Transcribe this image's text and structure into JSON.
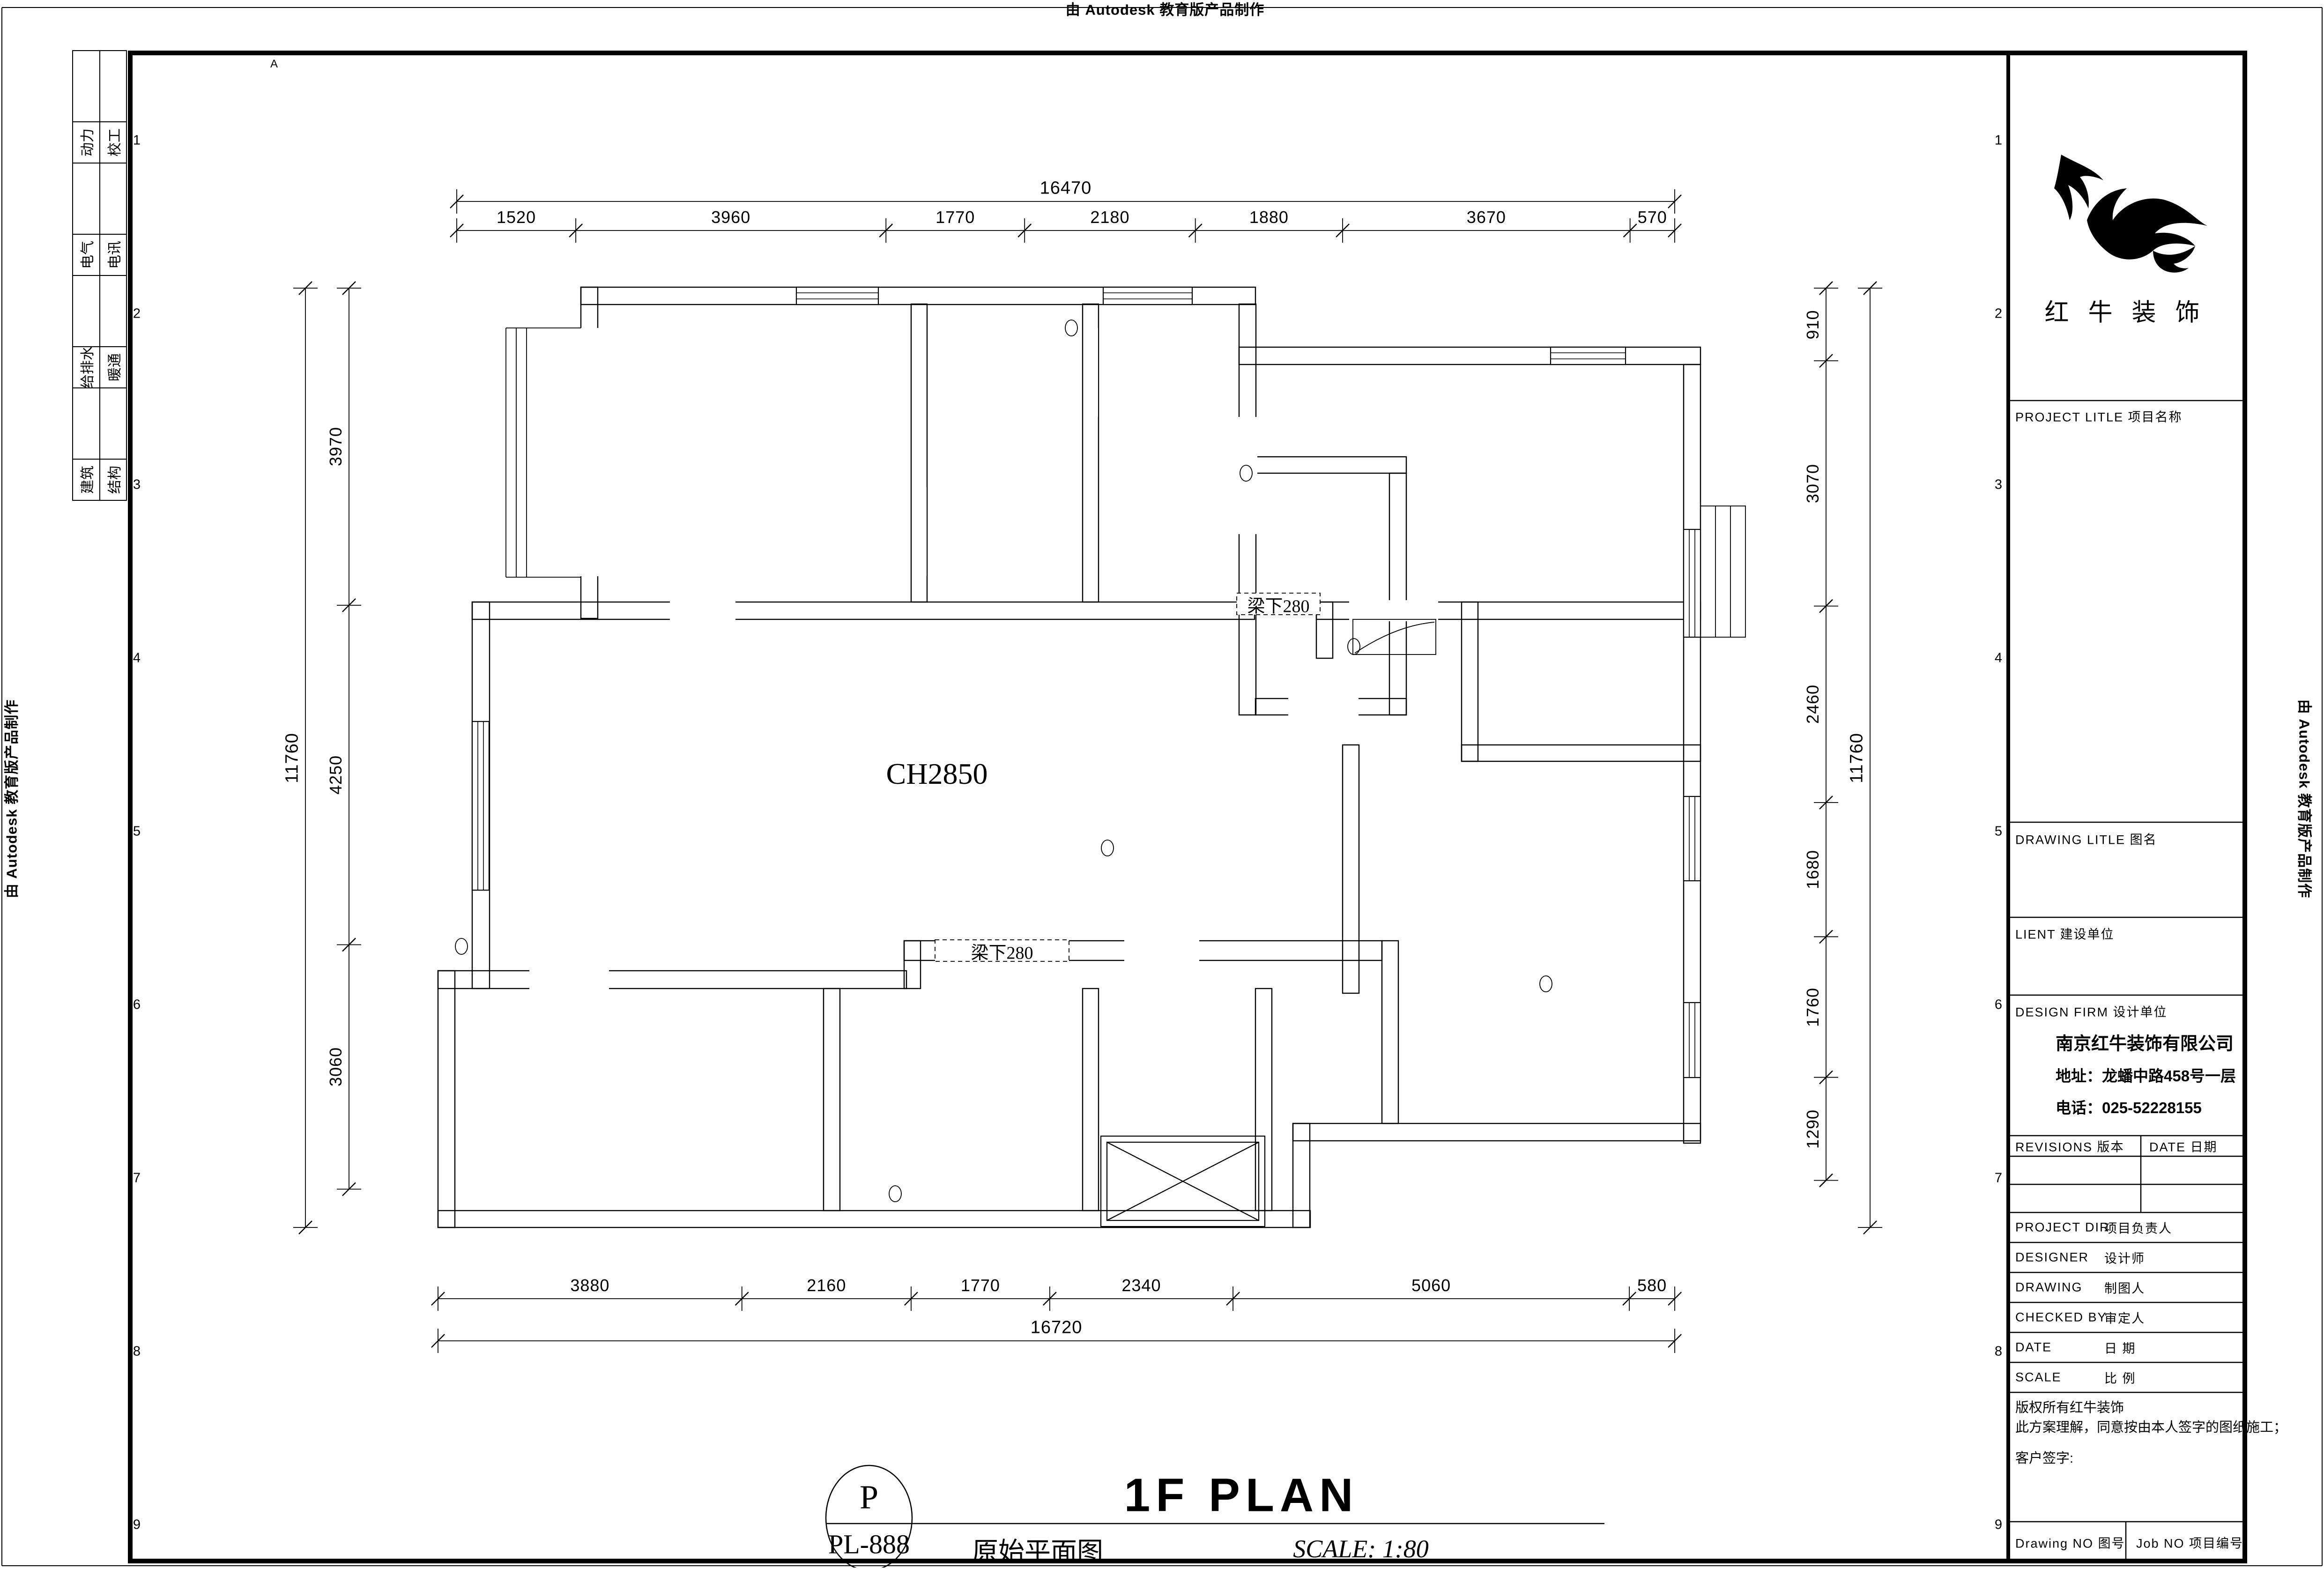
{
  "sheet": {
    "watermark_top": "由 Autodesk 教育版产品制作",
    "watermark_left": "由 Autodesk 教育版产品制作",
    "watermark_right": "由 Autodesk 教育版产品制作"
  },
  "frame_grid": {
    "left_numbers": [
      "1",
      "2",
      "3",
      "4",
      "5",
      "6",
      "7",
      "8",
      "9"
    ],
    "right_numbers": [
      "1",
      "2",
      "3",
      "4",
      "5",
      "6",
      "7",
      "8",
      "9"
    ],
    "top_letters": [
      "A"
    ]
  },
  "discipline_table": {
    "rows": [
      {
        "col1": "动力",
        "col2": "校工"
      },
      {
        "col1": "电气",
        "col2": "电讯"
      },
      {
        "col1": "给排水",
        "col2": "暖通"
      },
      {
        "col1": "建筑",
        "col2": "结构"
      }
    ]
  },
  "plan": {
    "room_height_label": "CH2850",
    "beam_labels": [
      "梁下280",
      "梁下280"
    ],
    "dimensions": {
      "top": {
        "total": "16470",
        "segments": [
          "1520",
          "3960",
          "1770",
          "2180",
          "1880",
          "3670",
          "570"
        ]
      },
      "bottom": {
        "total": "16720",
        "segments": [
          "3880",
          "2160",
          "1770",
          "2340",
          "5060",
          "580"
        ]
      },
      "left": {
        "total": "11760",
        "segments": [
          "3970",
          "4250",
          "3060"
        ]
      },
      "right": {
        "total": "11760",
        "segments": [
          "910",
          "3070",
          "2460",
          "1680",
          "1760",
          "1290"
        ]
      }
    }
  },
  "title_block": {
    "brand_name": "红 牛 装 饰",
    "project_title_label": "PROJECT LITLE    项目名称",
    "drawing_title_label": "DRAWING LITLE    图名",
    "client_label": "LIENT  建设单位",
    "design_firm_label": "DESIGN FIRM    设计单位",
    "firm_name": "南京红牛装饰有限公司",
    "firm_address": "地址：龙蟠中路458号一层",
    "firm_phone": "电话：025-52228155",
    "revisions_label": "REVISIONS 版本",
    "date_header_label": "DATE 日期",
    "rows": [
      {
        "en": "PROJECT DIR",
        "zh": "项目负责人"
      },
      {
        "en": "DESIGNER",
        "zh": "设计师"
      },
      {
        "en": "DRAWING",
        "zh": "制图人"
      },
      {
        "en": "CHECKED BY",
        "zh": "审定人"
      },
      {
        "en": "DATE",
        "zh": "日  期"
      },
      {
        "en": "SCALE",
        "zh": "比  例"
      }
    ],
    "copyright_line1": "版权所有红牛装饰",
    "copyright_line2": "此方案理解，同意按由本人签字的图纸施工；",
    "client_sign_label": "客户签字:",
    "drawing_no_label": "Drawing NO 图号",
    "job_no_label": "Job NO 项目编号"
  },
  "footer": {
    "stamp_letter": "P",
    "stamp_code": "PL-888",
    "plan_title": "1F PLAN",
    "plan_subtitle": "原始平面图",
    "scale_text": "SCALE: 1:80"
  }
}
